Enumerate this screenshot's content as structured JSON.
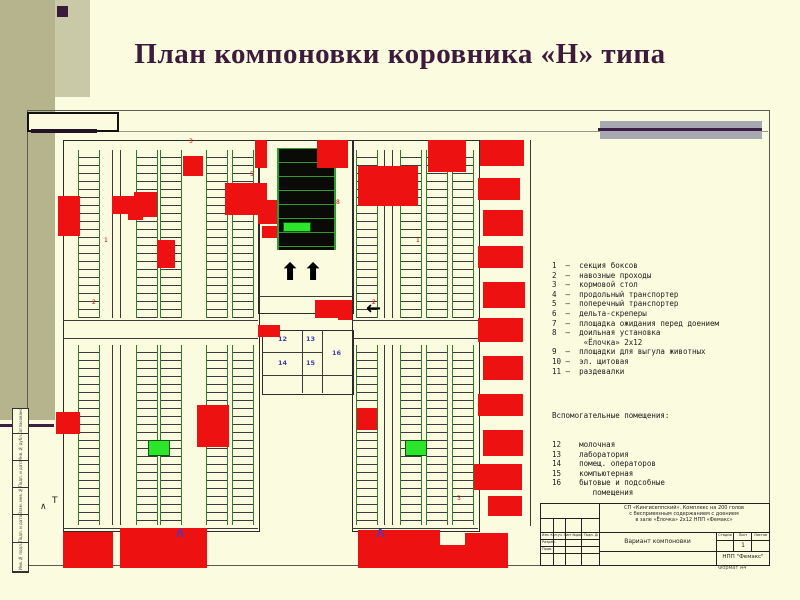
{
  "slide": {
    "title": "План компоновки коровника «Н» типа"
  },
  "colors": {
    "background": "#fbfbdf",
    "sidebar_olive": "#b5b48c",
    "sidebar_olive_light": "#c9c9a7",
    "title_maroon": "#3d1b3d",
    "accent_red": "#ee1111",
    "stall_green": "#2e7d2e",
    "bright_green": "#2ce52c",
    "purple_line": "#3c1f44",
    "gray_bar": "#a8a8b2",
    "blue_label": "#4040b0"
  },
  "legend": {
    "items": [
      "1  –  секция боксов",
      "2  –  навозные проходы",
      "3  –  кормовой стол",
      "4  –  продольный транспортер",
      "5  –  поперечный транспортер",
      "6  –  дельта-скреперы",
      "7  –  площадка ожидания перед доением",
      "8  –  доильная установка",
      "       «Ёлочка» 2х12",
      "9  –  площадки для выгула животных",
      "10 –  эл. щитовая",
      "11 –  раздевалки"
    ]
  },
  "aux": {
    "header": "Вспомогательные помещения:",
    "items": [
      "12    молочная",
      "13    лаборатория",
      "14    помещ. операторов",
      "15    компьютерная",
      "16    бытовые и подсобные",
      "         помещения"
    ]
  },
  "stamp": {
    "rev_header": "Изм. Кол.уч. Лист №док. Подп. Дата",
    "roles": [
      "Разраб.",
      "Пров."
    ],
    "project_lines": [
      "СП «Кингисеппский». Комплекс на 200 голов",
      "с беспривязным содержанием с доением",
      "в зале «Ёлочка» 2х12  НПП «Фемакс»"
    ],
    "doc_title": "Вариант компоновки",
    "cols": [
      "Стадия",
      "Лист",
      "Листов"
    ],
    "list_value": "1",
    "org": "НПП \"Фемакс\"",
    "format_note": "Формат А4"
  },
  "frame": {
    "side_cells": [
      {
        "label": "Согласовано",
        "h": 24
      },
      {
        "label": "Инв.№ дубл.",
        "h": 26
      },
      {
        "label": "Подп. и дата",
        "h": 26
      },
      {
        "label": "Взам. инв.№",
        "h": 26
      },
      {
        "label": "Подп. и дата",
        "h": 27
      },
      {
        "label": "Инв.№ подл.",
        "h": 28
      }
    ]
  },
  "plan": {
    "outlines": [
      {
        "x": 63,
        "y": 140,
        "w": 195,
        "h": 390
      },
      {
        "x": 352,
        "y": 140,
        "w": 126,
        "h": 390
      },
      {
        "x": 258,
        "y": 140,
        "w": 94,
        "h": 172
      },
      {
        "x": 262,
        "y": 330,
        "w": 90,
        "h": 63
      }
    ],
    "lines": [
      {
        "x": 63,
        "y": 320,
        "w": 195,
        "h": 1
      },
      {
        "x": 63,
        "y": 338,
        "w": 195,
        "h": 1
      },
      {
        "x": 352,
        "y": 320,
        "w": 126,
        "h": 1
      },
      {
        "x": 352,
        "y": 338,
        "w": 126,
        "h": 1
      },
      {
        "x": 530,
        "y": 140,
        "w": 1,
        "h": 386
      },
      {
        "x": 63,
        "y": 528,
        "w": 195,
        "h": 1
      },
      {
        "x": 352,
        "y": 528,
        "w": 126,
        "h": 1
      },
      {
        "x": 302,
        "y": 330,
        "w": 1,
        "h": 63
      },
      {
        "x": 322,
        "y": 330,
        "w": 1,
        "h": 63
      },
      {
        "x": 262,
        "y": 352,
        "w": 60,
        "h": 1
      },
      {
        "x": 262,
        "y": 375,
        "w": 90,
        "h": 1
      },
      {
        "x": 258,
        "y": 296,
        "w": 94,
        "h": 1
      },
      {
        "x": 112,
        "y": 150,
        "w": 1,
        "h": 168
      },
      {
        "x": 120,
        "y": 150,
        "w": 1,
        "h": 168
      },
      {
        "x": 112,
        "y": 345,
        "w": 1,
        "h": 180
      },
      {
        "x": 120,
        "y": 345,
        "w": 1,
        "h": 180
      },
      {
        "x": 384,
        "y": 150,
        "w": 1,
        "h": 168
      },
      {
        "x": 392,
        "y": 150,
        "w": 1,
        "h": 168
      },
      {
        "x": 384,
        "y": 345,
        "w": 1,
        "h": 180
      },
      {
        "x": 392,
        "y": 345,
        "w": 1,
        "h": 180
      }
    ],
    "ladders": [
      {
        "x": 78,
        "y": 150,
        "h": 168
      },
      {
        "x": 136,
        "y": 150,
        "h": 168
      },
      {
        "x": 160,
        "y": 150,
        "h": 168
      },
      {
        "x": 206,
        "y": 150,
        "h": 168
      },
      {
        "x": 232,
        "y": 150,
        "h": 168
      },
      {
        "x": 78,
        "y": 345,
        "h": 180
      },
      {
        "x": 136,
        "y": 345,
        "h": 180
      },
      {
        "x": 160,
        "y": 345,
        "h": 180
      },
      {
        "x": 206,
        "y": 345,
        "h": 180
      },
      {
        "x": 232,
        "y": 345,
        "h": 180
      },
      {
        "x": 356,
        "y": 150,
        "h": 168
      },
      {
        "x": 400,
        "y": 150,
        "h": 168
      },
      {
        "x": 426,
        "y": 150,
        "h": 168
      },
      {
        "x": 452,
        "y": 150,
        "h": 168
      },
      {
        "x": 356,
        "y": 345,
        "h": 180
      },
      {
        "x": 400,
        "y": 345,
        "h": 180
      },
      {
        "x": 426,
        "y": 345,
        "h": 180
      },
      {
        "x": 452,
        "y": 345,
        "h": 180
      }
    ],
    "black_blocks": [
      {
        "x": 277,
        "y": 148,
        "w": 55,
        "h": 102
      }
    ],
    "red_blocks": [
      {
        "x": 255,
        "y": 140,
        "w": 12,
        "h": 28
      },
      {
        "x": 317,
        "y": 140,
        "w": 31,
        "h": 28
      },
      {
        "x": 428,
        "y": 140,
        "w": 38,
        "h": 32
      },
      {
        "x": 358,
        "y": 166,
        "w": 60,
        "h": 40
      },
      {
        "x": 225,
        "y": 183,
        "w": 42,
        "h": 32
      },
      {
        "x": 183,
        "y": 156,
        "w": 20,
        "h": 20
      },
      {
        "x": 112,
        "y": 196,
        "w": 25,
        "h": 18
      },
      {
        "x": 128,
        "y": 208,
        "w": 15,
        "h": 12
      },
      {
        "x": 134,
        "y": 192,
        "w": 23,
        "h": 25
      },
      {
        "x": 58,
        "y": 196,
        "w": 22,
        "h": 40
      },
      {
        "x": 157,
        "y": 240,
        "w": 18,
        "h": 28
      },
      {
        "x": 258,
        "y": 200,
        "w": 19,
        "h": 24
      },
      {
        "x": 262,
        "y": 226,
        "w": 15,
        "h": 12
      },
      {
        "x": 315,
        "y": 300,
        "w": 23,
        "h": 18
      },
      {
        "x": 338,
        "y": 300,
        "w": 14,
        "h": 20
      },
      {
        "x": 258,
        "y": 325,
        "w": 22,
        "h": 12
      },
      {
        "x": 357,
        "y": 408,
        "w": 20,
        "h": 22
      },
      {
        "x": 197,
        "y": 405,
        "w": 32,
        "h": 42
      },
      {
        "x": 56,
        "y": 412,
        "w": 24,
        "h": 22
      },
      {
        "x": 480,
        "y": 140,
        "w": 44,
        "h": 26
      },
      {
        "x": 478,
        "y": 178,
        "w": 42,
        "h": 22
      },
      {
        "x": 483,
        "y": 210,
        "w": 40,
        "h": 26
      },
      {
        "x": 478,
        "y": 246,
        "w": 45,
        "h": 22
      },
      {
        "x": 483,
        "y": 282,
        "w": 42,
        "h": 26
      },
      {
        "x": 478,
        "y": 318,
        "w": 45,
        "h": 24
      },
      {
        "x": 483,
        "y": 356,
        "w": 40,
        "h": 24
      },
      {
        "x": 478,
        "y": 394,
        "w": 45,
        "h": 22
      },
      {
        "x": 483,
        "y": 430,
        "w": 40,
        "h": 26
      },
      {
        "x": 474,
        "y": 464,
        "w": 48,
        "h": 26
      },
      {
        "x": 488,
        "y": 496,
        "w": 34,
        "h": 20
      },
      {
        "x": 63,
        "y": 532,
        "w": 50,
        "h": 36
      },
      {
        "x": 120,
        "y": 528,
        "w": 87,
        "h": 40
      },
      {
        "x": 358,
        "y": 530,
        "w": 82,
        "h": 38
      },
      {
        "x": 440,
        "y": 545,
        "w": 25,
        "h": 23
      },
      {
        "x": 465,
        "y": 533,
        "w": 43,
        "h": 35
      }
    ],
    "green_blocks": [
      {
        "x": 283,
        "y": 222,
        "w": 26,
        "h": 8
      },
      {
        "x": 148,
        "y": 440,
        "w": 20,
        "h": 14
      },
      {
        "x": 405,
        "y": 440,
        "w": 20,
        "h": 14
      }
    ],
    "up_arrows": [
      {
        "x": 280,
        "y": 260
      },
      {
        "x": 303,
        "y": 260
      }
    ],
    "left_arrow": {
      "x": 366,
      "y": 300,
      "t": "←"
    },
    "labels_blue": [
      {
        "t": "12",
        "x": 278,
        "y": 336
      },
      {
        "t": "13",
        "x": 306,
        "y": 336
      },
      {
        "t": "14",
        "x": 278,
        "y": 360
      },
      {
        "t": "15",
        "x": 306,
        "y": 360
      },
      {
        "t": "16",
        "x": 332,
        "y": 350
      }
    ],
    "labels_red": [
      {
        "t": "3",
        "x": 189,
        "y": 139
      },
      {
        "t": "5",
        "x": 250,
        "y": 172
      },
      {
        "t": "8",
        "x": 336,
        "y": 200
      },
      {
        "t": "1",
        "x": 104,
        "y": 238
      },
      {
        "t": "2",
        "x": 92,
        "y": 300
      },
      {
        "t": "1",
        "x": 416,
        "y": 238
      },
      {
        "t": "2",
        "x": 372,
        "y": 300
      },
      {
        "t": "3",
        "x": 457,
        "y": 496
      }
    ],
    "marks": [
      {
        "t": "Λ",
        "x": 176,
        "y": 528,
        "cls": "mark"
      },
      {
        "t": "Λ",
        "x": 376,
        "y": 528,
        "cls": "mark"
      },
      {
        "t": "∧",
        "x": 40,
        "y": 503,
        "cls": "smark"
      },
      {
        "t": "Т",
        "x": 52,
        "y": 497,
        "cls": "smark"
      }
    ]
  }
}
